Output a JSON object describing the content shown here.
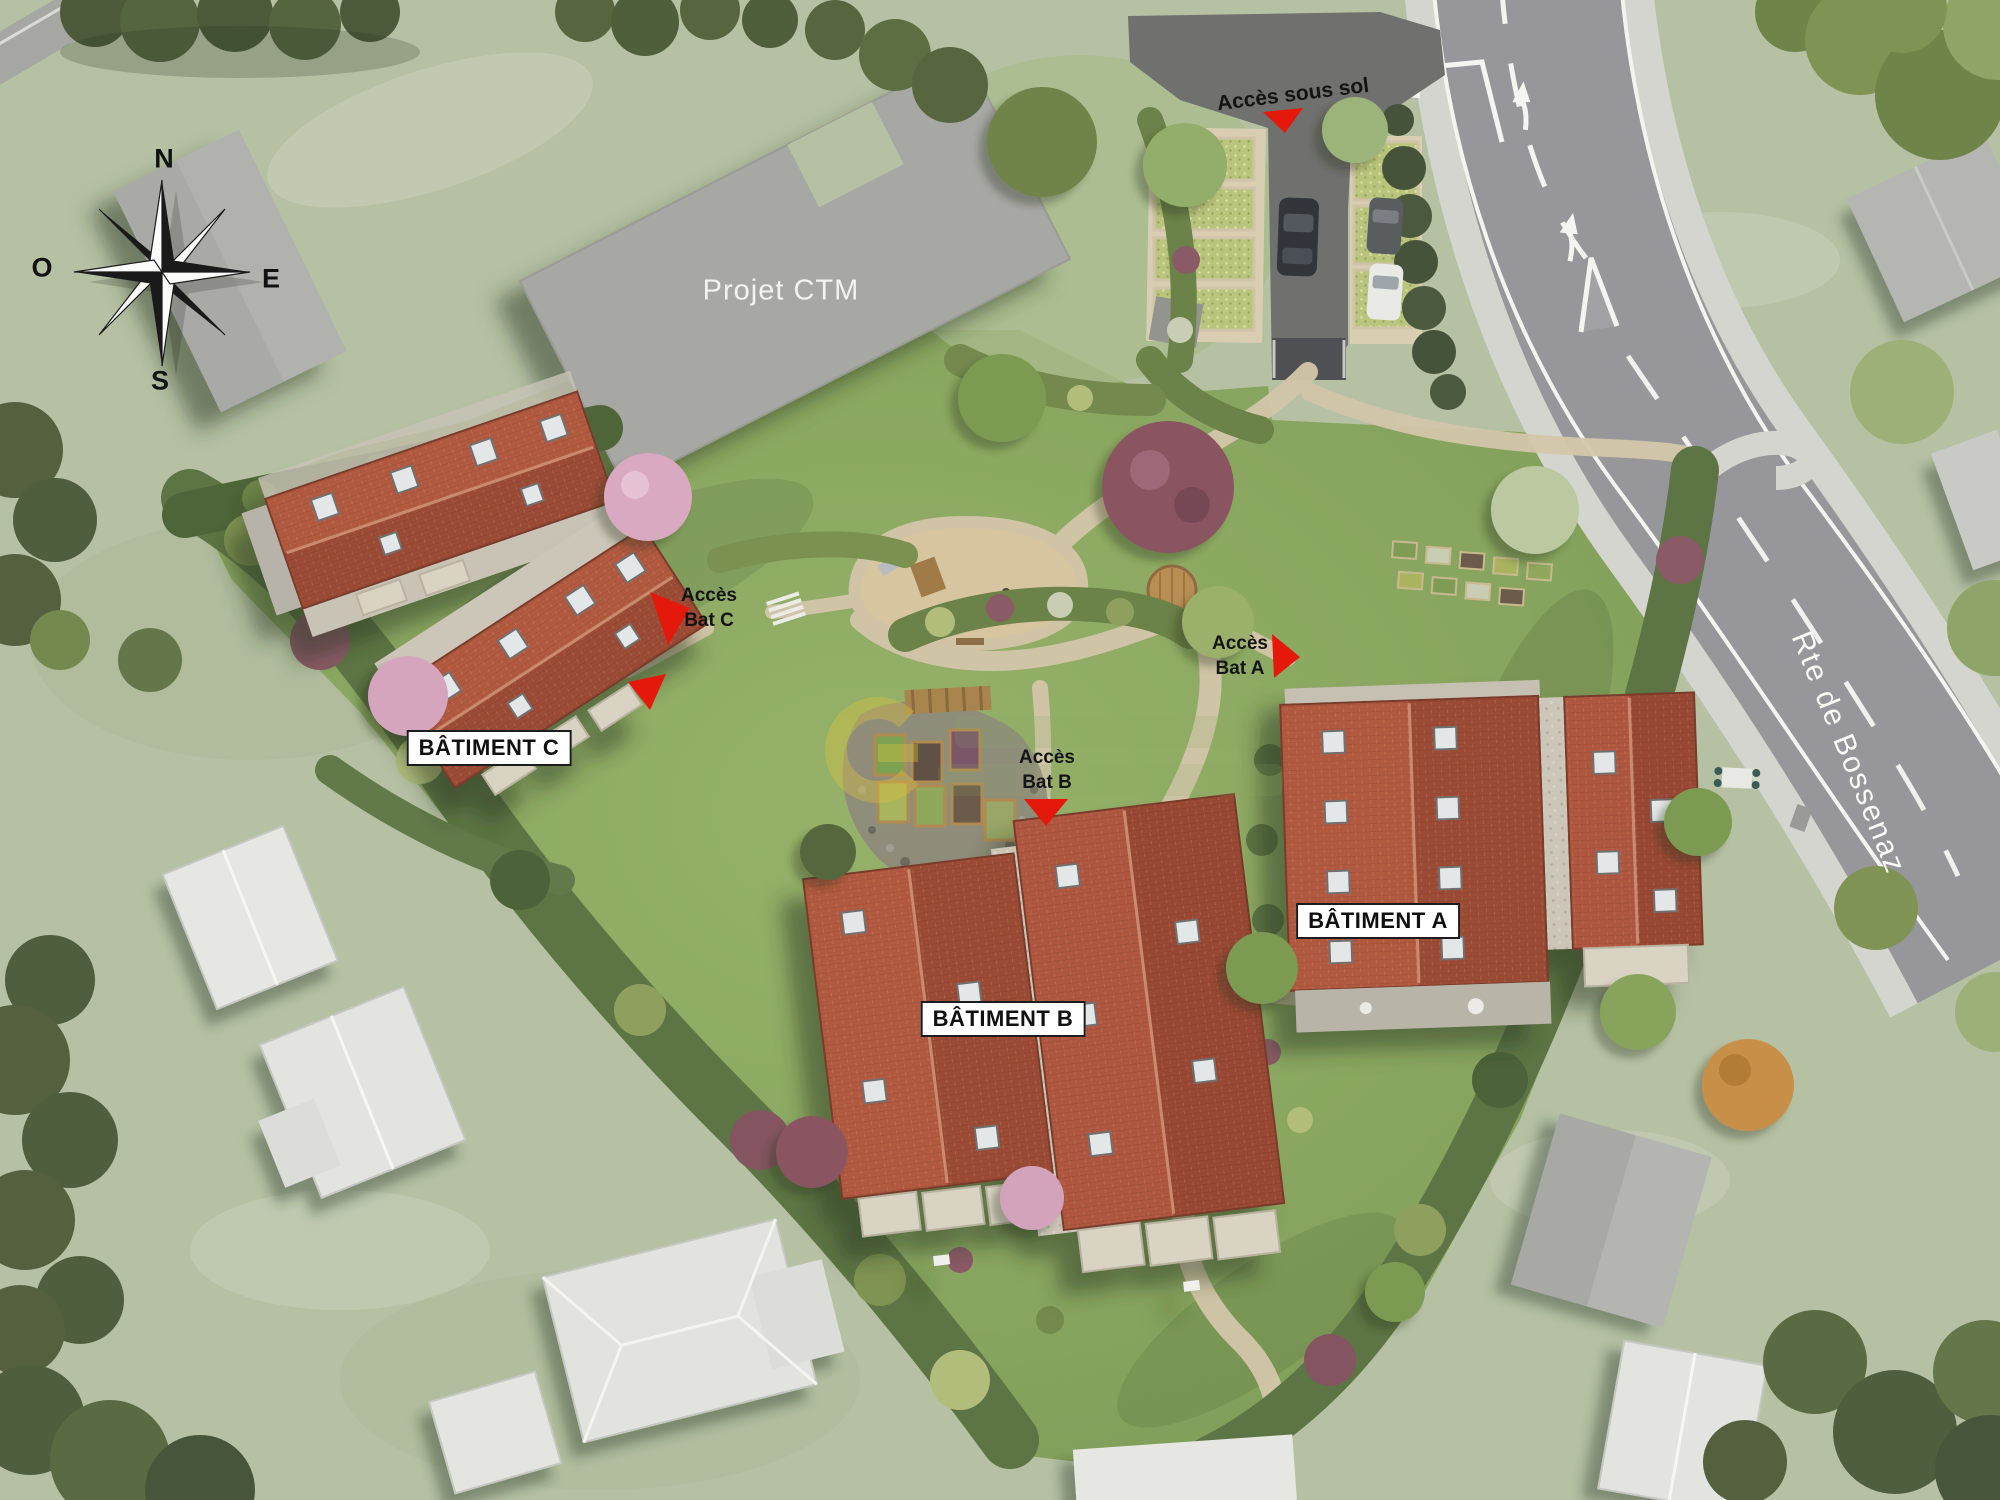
{
  "compass": {
    "north": "N",
    "south": "S",
    "east": "E",
    "west": "O"
  },
  "neighbor": {
    "projet_ctm": "Projet CTM"
  },
  "road": {
    "name": "Rte de Bossenaz"
  },
  "access": {
    "sous_sol": "Accès sous sol",
    "bat_a": {
      "line1": "Accès",
      "line2": "Bat A"
    },
    "bat_b": {
      "line1": "Accès",
      "line2": "Bat B"
    },
    "bat_c": {
      "line1": "Accès",
      "line2": "Bat C"
    }
  },
  "buildings": [
    {
      "id": "a",
      "label": "BÂTIMENT A"
    },
    {
      "id": "b",
      "label": "BÂTIMENT B"
    },
    {
      "id": "c",
      "label": "BÂTIMENT C"
    }
  ],
  "colors": {
    "accent_red": "#e4190c",
    "roof_red_light": "#b25a40",
    "roof_red_dark": "#9c4c36",
    "site_green": "#8aa763",
    "outer_green": "#b6c1a4",
    "road_gray": "#97979b",
    "path_beige": "#d3c6aa",
    "label_bg": "#ffffff",
    "label_text": "#121212"
  }
}
